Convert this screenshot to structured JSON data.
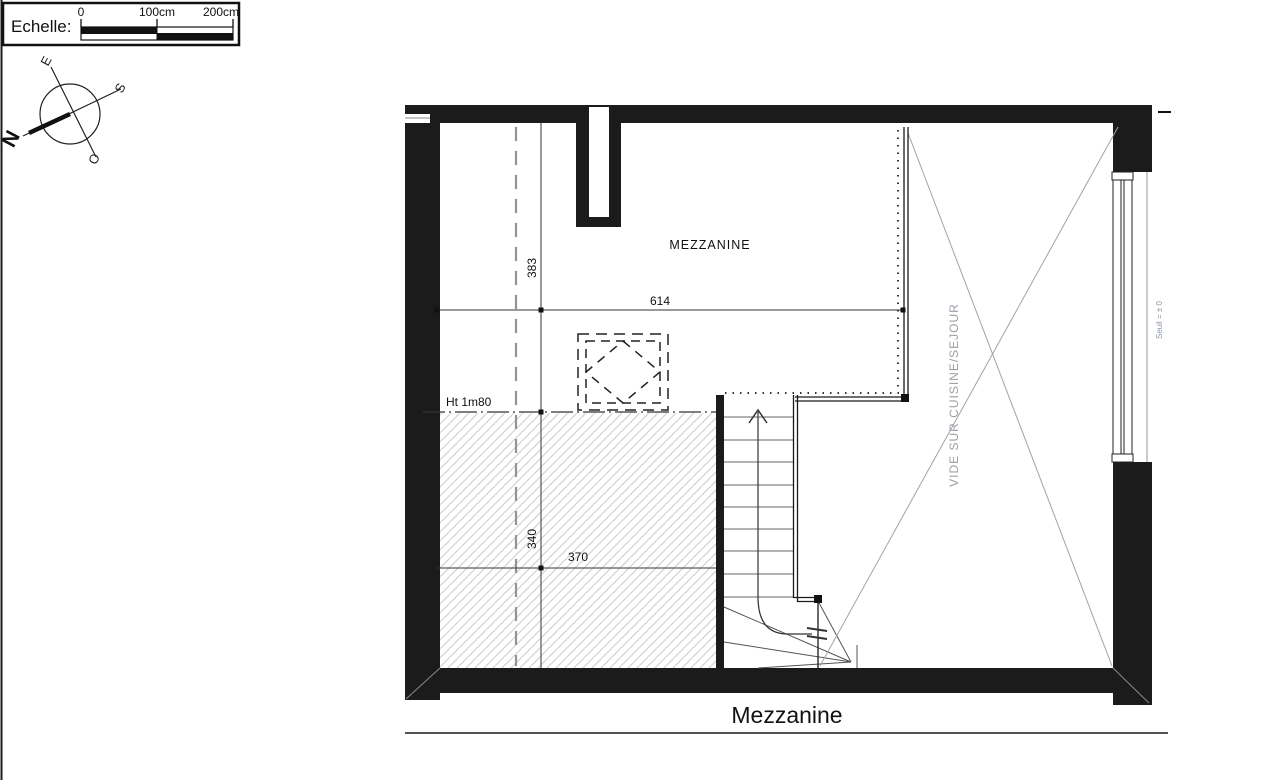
{
  "scale_bar": {
    "label": "Echelle:",
    "ticks": [
      "0",
      "100cm",
      "200cm"
    ]
  },
  "compass": {
    "n": "N",
    "s": "S",
    "e": "E",
    "o": "O"
  },
  "plan": {
    "room_label": "MEZZANINE",
    "void_label": "VIDE SUR CUISINE/SEJOUR",
    "threshold_label": "Seuil = ± 0",
    "height_note": "Ht 1m80",
    "dims": {
      "top_width": "614",
      "left_upper": "383",
      "left_lower": "340",
      "bottom_width": "370"
    }
  },
  "title": "Mezzanine",
  "colors": {
    "wall": "#1b1b1b",
    "line": "#333333",
    "hatch": "#d2d2d2",
    "void_line": "#a3a3a3",
    "dashed_line": "#949494",
    "vide_text": "#9aa0a6",
    "seuil_text": "#8b95a5"
  }
}
